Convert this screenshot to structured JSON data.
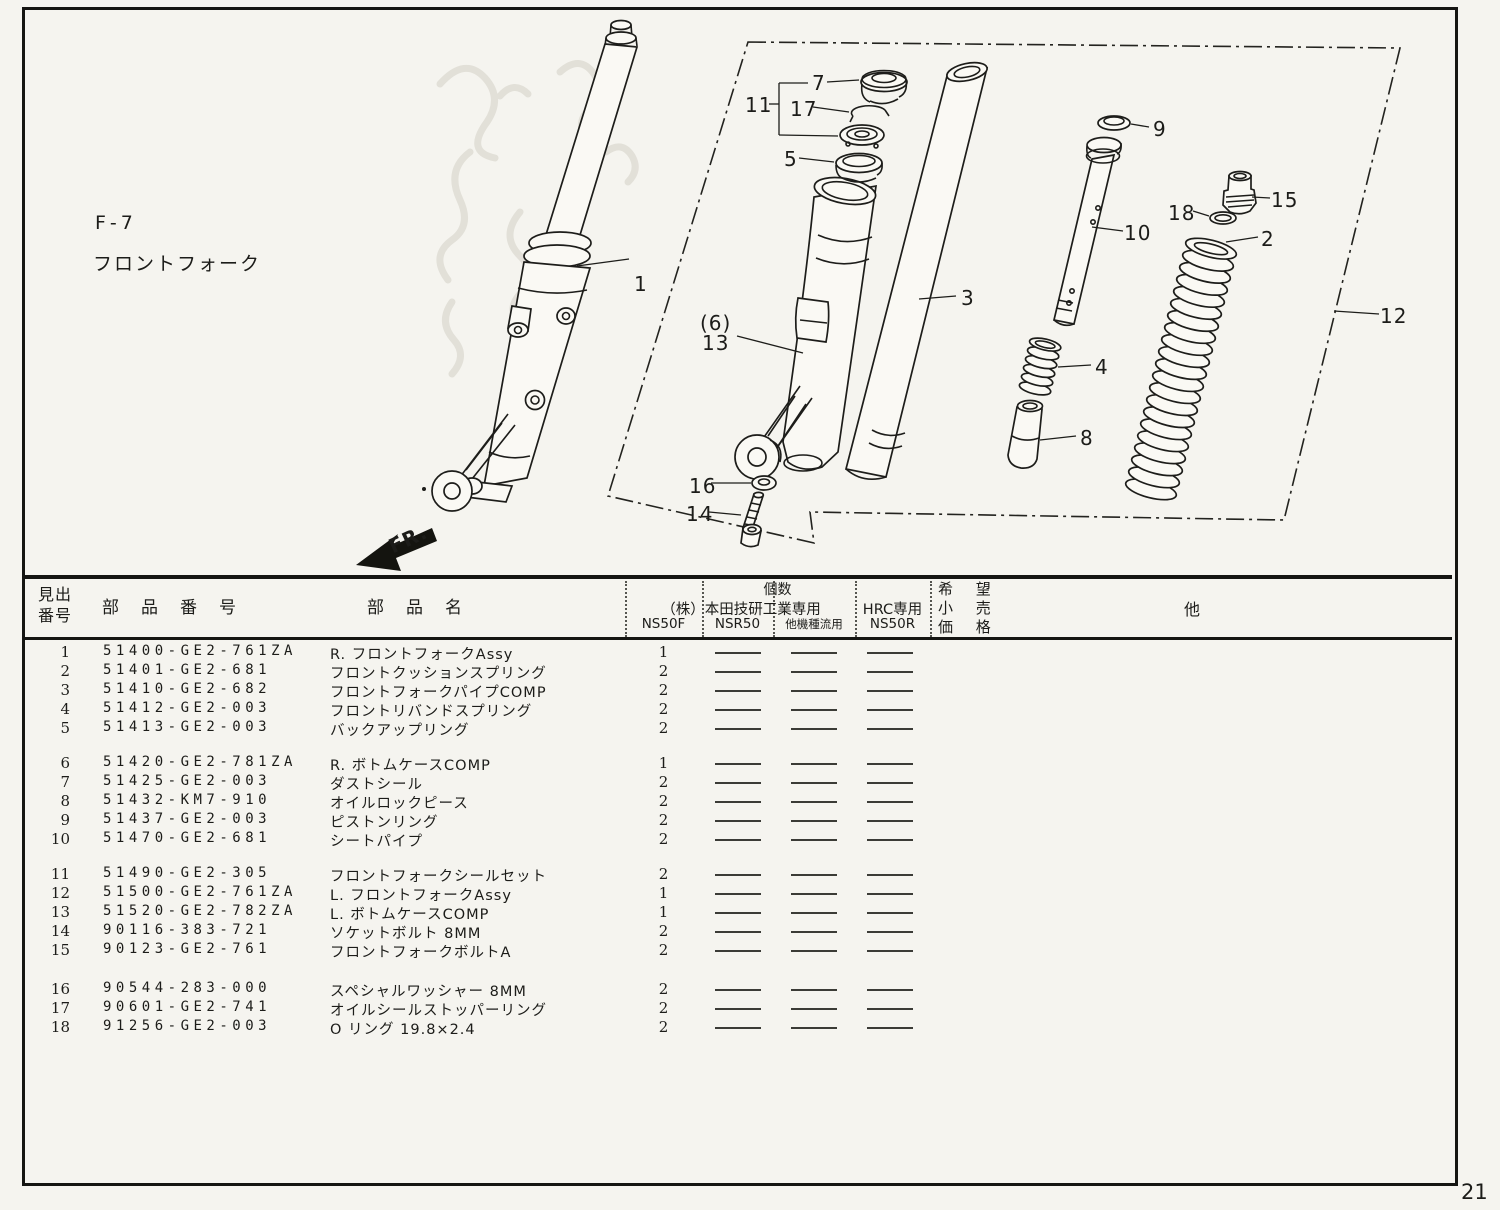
{
  "page": {
    "number": "21"
  },
  "diagram": {
    "section_code": "F-7",
    "section_title": "フロントフォーク",
    "fr_label": "FR.",
    "callouts": [
      "1",
      "3",
      "(6)",
      "13",
      "7",
      "17",
      "11",
      "5",
      "9",
      "10",
      "15",
      "18",
      "2",
      "4",
      "8",
      "12",
      "16",
      "14"
    ]
  },
  "table": {
    "headers": {
      "index_l1": "見出",
      "index_l2": "番号",
      "part_number": "部品番号",
      "part_name": "部品名",
      "qty_group": "個数",
      "honda_group": "（株）本田技研工業専用",
      "hrc_group": "HRC専用",
      "ns50f": "NS50F",
      "nsr50": "NSR50",
      "other_models": "他機種流用",
      "ns50r": "NS50R",
      "price_l1": "希 望",
      "price_l2": "小 売",
      "price_l3": "価 格",
      "other": "他"
    },
    "rows": [
      {
        "no": "1",
        "part_number": "51400-GE2-761ZA",
        "name": "R. フロントフォークAssy",
        "ns50f": "1",
        "nsr50": "—",
        "other": "—",
        "ns50r": "—"
      },
      {
        "no": "2",
        "part_number": "51401-GE2-681",
        "name": "フロントクッションスプリング",
        "ns50f": "2",
        "nsr50": "—",
        "other": "—",
        "ns50r": "—"
      },
      {
        "no": "3",
        "part_number": "51410-GE2-682",
        "name": "フロントフォークパイプCOMP",
        "ns50f": "2",
        "nsr50": "—",
        "other": "—",
        "ns50r": "—"
      },
      {
        "no": "4",
        "part_number": "51412-GE2-003",
        "name": "フロントリバンドスプリング",
        "ns50f": "2",
        "nsr50": "—",
        "other": "—",
        "ns50r": "—"
      },
      {
        "no": "5",
        "part_number": "51413-GE2-003",
        "name": "バックアップリング",
        "ns50f": "2",
        "nsr50": "—",
        "other": "—",
        "ns50r": "—"
      },
      {
        "no": "6",
        "part_number": "51420-GE2-781ZA",
        "name": "R. ボトムケースCOMP",
        "ns50f": "1",
        "nsr50": "—",
        "other": "—",
        "ns50r": "—"
      },
      {
        "no": "7",
        "part_number": "51425-GE2-003",
        "name": "ダストシール",
        "ns50f": "2",
        "nsr50": "—",
        "other": "—",
        "ns50r": "—"
      },
      {
        "no": "8",
        "part_number": "51432-KM7-910",
        "name": "オイルロックピース",
        "ns50f": "2",
        "nsr50": "—",
        "other": "—",
        "ns50r": "—"
      },
      {
        "no": "9",
        "part_number": "51437-GE2-003",
        "name": "ピストンリング",
        "ns50f": "2",
        "nsr50": "—",
        "other": "—",
        "ns50r": "—"
      },
      {
        "no": "10",
        "part_number": "51470-GE2-681",
        "name": "シートパイプ",
        "ns50f": "2",
        "nsr50": "—",
        "other": "—",
        "ns50r": "—"
      },
      {
        "no": "11",
        "part_number": "51490-GE2-305",
        "name": "フロントフォークシールセット",
        "ns50f": "2",
        "nsr50": "—",
        "other": "—",
        "ns50r": "—"
      },
      {
        "no": "12",
        "part_number": "51500-GE2-761ZA",
        "name": "L. フロントフォークAssy",
        "ns50f": "1",
        "nsr50": "—",
        "other": "—",
        "ns50r": "—"
      },
      {
        "no": "13",
        "part_number": "51520-GE2-782ZA",
        "name": "L. ボトムケースCOMP",
        "ns50f": "1",
        "nsr50": "—",
        "other": "—",
        "ns50r": "—"
      },
      {
        "no": "14",
        "part_number": "90116-383-721",
        "name": "ソケットボルト 8MM",
        "ns50f": "2",
        "nsr50": "—",
        "other": "—",
        "ns50r": "—"
      },
      {
        "no": "15",
        "part_number": "90123-GE2-761",
        "name": "フロントフォークボルトA",
        "ns50f": "2",
        "nsr50": "—",
        "other": "—",
        "ns50r": "—"
      },
      {
        "no": "16",
        "part_number": "90544-283-000",
        "name": "スペシャルワッシャー 8MM",
        "ns50f": "2",
        "nsr50": "—",
        "other": "—",
        "ns50r": "—"
      },
      {
        "no": "17",
        "part_number": "90601-GE2-741",
        "name": "オイルシールストッパーリング",
        "ns50f": "2",
        "nsr50": "—",
        "other": "—",
        "ns50r": "—"
      },
      {
        "no": "18",
        "part_number": "91256-GE2-003",
        "name": "O リング 19.8×2.4",
        "ns50f": "2",
        "nsr50": "—",
        "other": "—",
        "ns50r": "—"
      }
    ]
  }
}
